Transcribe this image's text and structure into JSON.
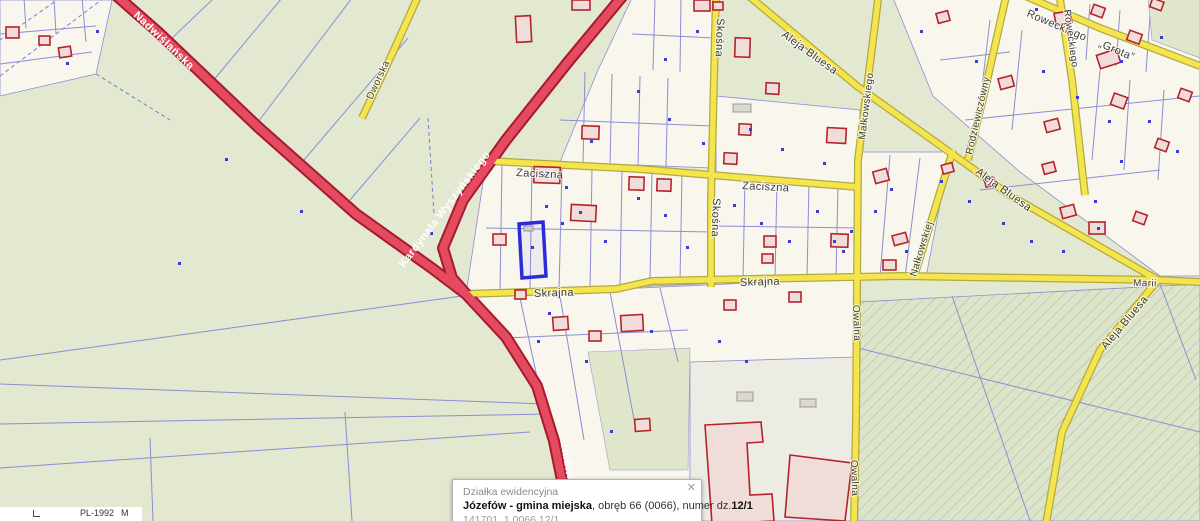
{
  "popup": {
    "title": "Działka ewidencyjna",
    "municipality": "Józefów - gmina miejska",
    "details": ", obręb 66 (0066), numer dz.",
    "parcel_short": "12/1",
    "parcel_id": "141701_1.0066.12/1",
    "close_icon": "✕"
  },
  "footer": {
    "crs_label": "PL-1992",
    "scale_letter": "M"
  },
  "roads": {
    "nadwislanska": "Nadwiślańska",
    "wyszynskiego": "Kardynała Wyszyńskiego",
    "zaciszna": "Zaciszna",
    "skrajna": "Skrajna",
    "skosna": "Skośna",
    "bluesa": "Aleja Bluesa",
    "malkowskiego": "Małkowskiego",
    "owalna": "Owalna",
    "nalkowskiej": "Nałkowskiej",
    "rodziewiczowny": "Rodziewiczówny",
    "roweckiego": "Roweckiego",
    "grota": "„Grota”",
    "dworska": "Dworska",
    "marii": "Marii"
  },
  "colors": {
    "green_base": "#e3e8d0",
    "parcel_cream": "#f9f6ee",
    "road_red": "#e54b5e",
    "road_red_casing": "#a81832",
    "road_yellow": "#f4e54f",
    "road_yellow_casing": "#b3a93e",
    "parcel_line": "#8d8dd2",
    "building_stroke": "#b5242c",
    "building_fill": "#f0dcd8",
    "selection_blue": "#2b2bdc",
    "point_blue": "#3c3cd2"
  }
}
